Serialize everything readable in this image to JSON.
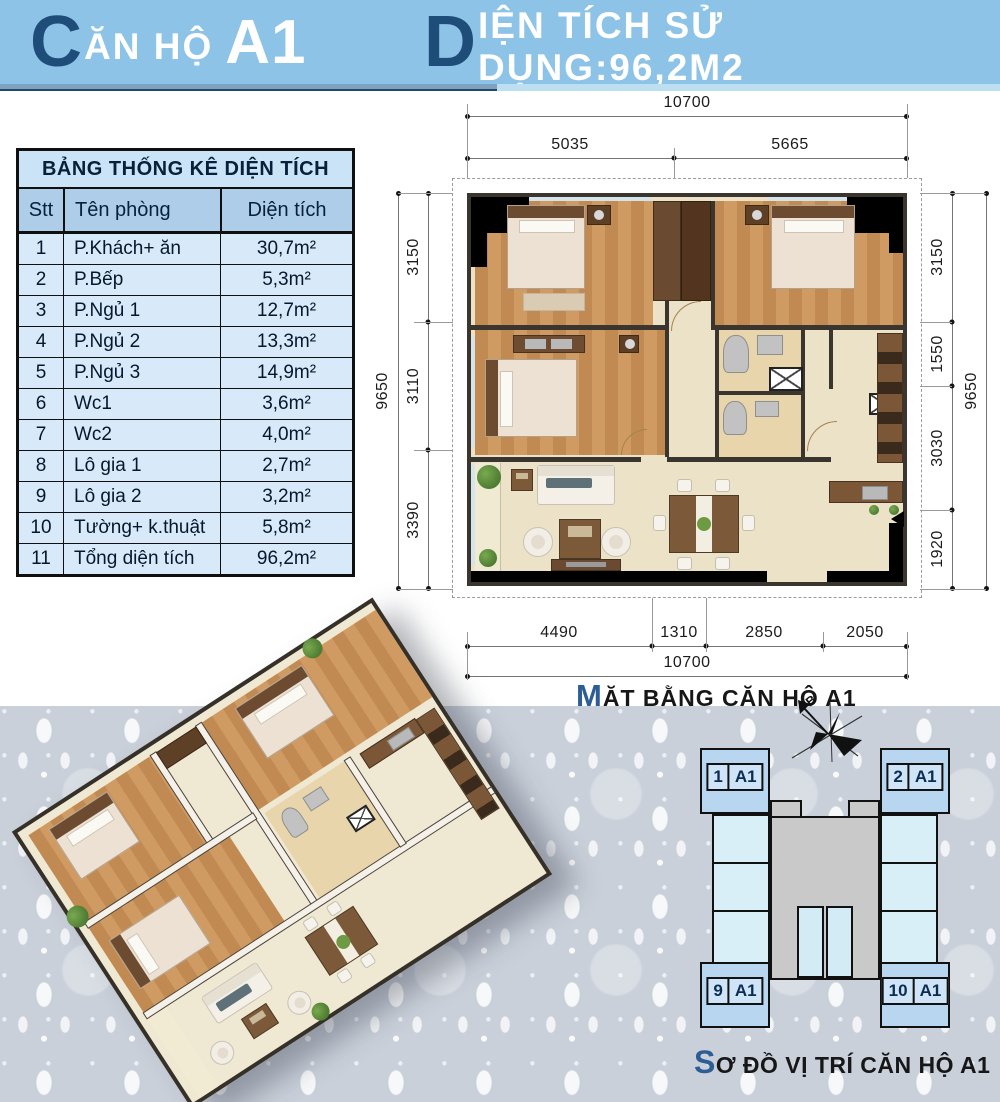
{
  "header": {
    "left": {
      "initial": "C",
      "rest": "ĂN HỘ",
      "unit": "A1"
    },
    "right": {
      "initial": "D",
      "rest": "IỆN TÍCH SỬ DỤNG:96,2M2"
    },
    "colors": {
      "bar": "#8cc3e6",
      "accent": "#1d4d78"
    }
  },
  "area_table": {
    "title": "BẢNG THỐNG KÊ DIỆN TÍCH",
    "columns": [
      "Stt",
      "Tên phòng",
      "Diện tích"
    ],
    "rows": [
      [
        "1",
        "P.Khách+ ăn",
        "30,7m²"
      ],
      [
        "2",
        "P.Bếp",
        "5,3m²"
      ],
      [
        "3",
        "P.Ngủ 1",
        "12,7m²"
      ],
      [
        "4",
        "P.Ngủ 2",
        "13,3m²"
      ],
      [
        "5",
        "P.Ngủ 3",
        "14,9m²"
      ],
      [
        "6",
        "Wc1",
        "3,6m²"
      ],
      [
        "7",
        "Wc2",
        "4,0m²"
      ],
      [
        "8",
        "Lô gia 1",
        "2,7m²"
      ],
      [
        "9",
        "Lô gia 2",
        "3,2m²"
      ],
      [
        "10",
        "Tường+ k.thuật",
        "5,8m²"
      ],
      [
        "11",
        "Tổng diện tích",
        "96,2m²"
      ]
    ],
    "colors": {
      "title_bg": "#cbe3f6",
      "head_bg": "#aecde9",
      "row_bg": "#d8eaf9"
    }
  },
  "floor_plan": {
    "caption": {
      "initial": "M",
      "rest": "ẶT BẰNG CĂN HỘ A1"
    },
    "dimensions": {
      "top_total": "10700",
      "top_segments": [
        "5035",
        "5665"
      ],
      "left_segments": [
        "3150",
        "3110",
        "3390"
      ],
      "left_total": "9650",
      "right_segments": [
        "3150",
        "1550",
        "3030",
        "1920"
      ],
      "right_total": "9650",
      "bottom_segments": [
        "4490",
        "1310",
        "2850",
        "2050"
      ],
      "bottom_total": "10700"
    }
  },
  "location_diagram": {
    "caption": {
      "initial": "S",
      "rest": "Ơ ĐỒ VỊ TRÍ CĂN HỘ A1"
    },
    "compass_label": "B",
    "units": [
      {
        "num": "1",
        "type": "A1",
        "position": "top-left"
      },
      {
        "num": "2",
        "type": "A1",
        "position": "top-right"
      },
      {
        "num": "9",
        "type": "A1",
        "position": "bottom-left"
      },
      {
        "num": "10",
        "type": "A1",
        "position": "bottom-right"
      }
    ]
  }
}
